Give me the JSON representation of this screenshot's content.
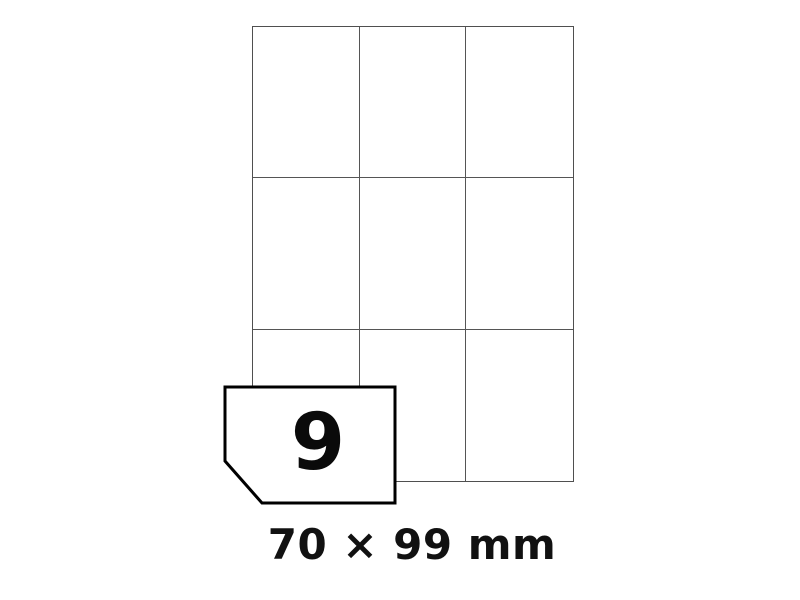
{
  "illustration": {
    "background": "#ffffff",
    "sheet": {
      "rows": 3,
      "columns": 3,
      "label_count_total": 9,
      "line_color": "#4f4f4f"
    },
    "card": {
      "count": "9",
      "border_color": "#000000",
      "fill_color": "#ffffff"
    },
    "caption": {
      "text": "70 × 99 mm",
      "color": "#111111"
    }
  }
}
